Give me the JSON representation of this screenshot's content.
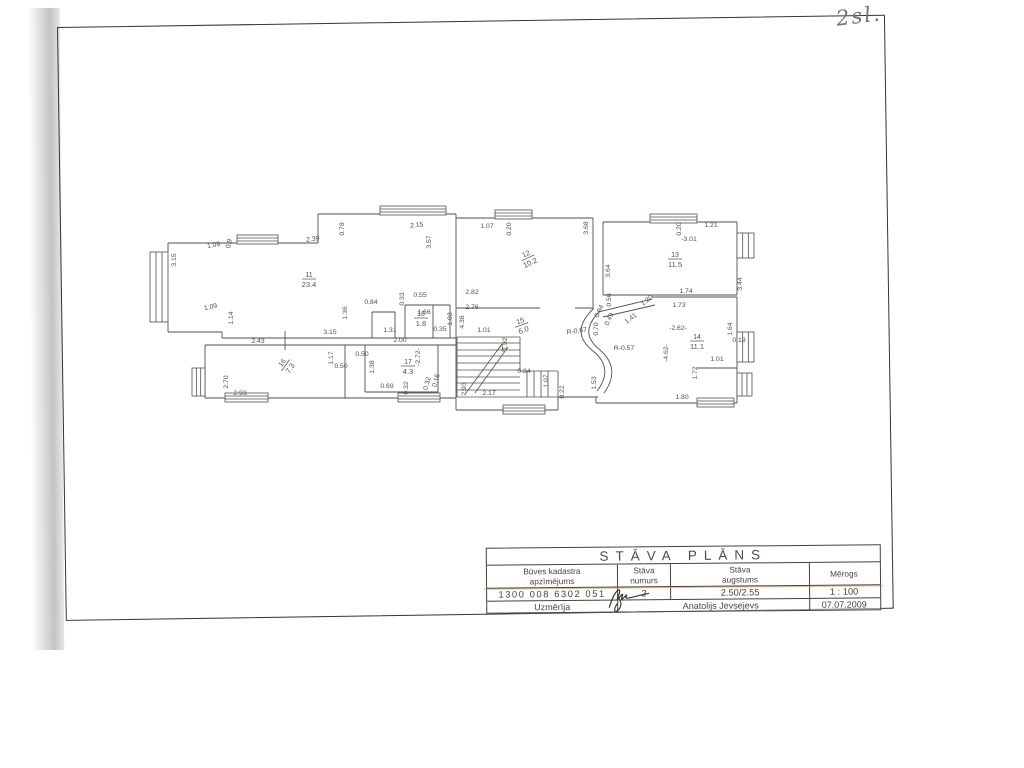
{
  "page": {
    "handwriting": "2sl.",
    "ink": "#544e46",
    "accent_highlight": "#d0802a"
  },
  "title_block": {
    "title": "STĀVA PLĀNS",
    "header_lines": [
      [
        "Būves kadastra",
        "apzīmējums"
      ],
      [
        "Stāva",
        "numurs"
      ],
      [
        "Stāva",
        "augstums"
      ],
      [
        "Mērogs",
        ""
      ]
    ],
    "values": [
      "1300 008 6302 051",
      "2",
      "2.50/2.55",
      "1 : 100"
    ],
    "surveyor_label": "Uzmērīja",
    "surveyor_name": "Anatolijs Jevsejevs",
    "date": "07.07.2009"
  },
  "plan": {
    "rooms": [
      {
        "num": "11",
        "area": "23.4",
        "x": 309,
        "y": 277,
        "r": 0
      },
      {
        "num": "12",
        "area": "10.2",
        "x": 527,
        "y": 256,
        "r": -25
      },
      {
        "num": "13",
        "area": "11.5",
        "x": 675,
        "y": 257,
        "r": 0
      },
      {
        "num": "14",
        "area": "11.1",
        "x": 697,
        "y": 339,
        "r": 0
      },
      {
        "num": "15",
        "area": "6.0",
        "x": 521,
        "y": 323,
        "r": -20
      },
      {
        "num": "16",
        "area": "7.3",
        "x": 284,
        "y": 364,
        "r": -55
      },
      {
        "num": "17",
        "area": "4.3",
        "x": 408,
        "y": 364,
        "r": 0
      },
      {
        "num": "18",
        "area": "1.8",
        "x": 421,
        "y": 316,
        "r": 0
      }
    ],
    "dims": [
      {
        "t": "1.09",
        "x": 214,
        "y": 247,
        "r": -10
      },
      {
        "t": "0.9",
        "x": 231,
        "y": 244,
        "r": -80
      },
      {
        "t": "2.39",
        "x": 313,
        "y": 241,
        "r": -6
      },
      {
        "t": "0.78",
        "x": 344,
        "y": 229,
        "r": -90
      },
      {
        "t": "2.15",
        "x": 417,
        "y": 227,
        "r": -6
      },
      {
        "t": "3.57",
        "x": 431,
        "y": 242,
        "r": -90
      },
      {
        "t": "1.07",
        "x": 487,
        "y": 228,
        "r": 0
      },
      {
        "t": "0.20",
        "x": 511,
        "y": 229,
        "r": -90
      },
      {
        "t": "3.68",
        "x": 588,
        "y": 228,
        "r": -90
      },
      {
        "t": "0.20",
        "x": 681,
        "y": 229,
        "r": -90
      },
      {
        "t": "1.21",
        "x": 711,
        "y": 227,
        "r": 0
      },
      {
        "t": "-3.01",
        "x": 689,
        "y": 241,
        "r": 0
      },
      {
        "t": "3.44",
        "x": 742,
        "y": 284,
        "r": -90
      },
      {
        "t": "3.15",
        "x": 176,
        "y": 260,
        "r": -90
      },
      {
        "t": "1.09",
        "x": 211,
        "y": 309,
        "r": -12
      },
      {
        "t": "1.14",
        "x": 233,
        "y": 318,
        "r": -90
      },
      {
        "t": "3.15",
        "x": 330,
        "y": 334,
        "r": 0
      },
      {
        "t": "0.84",
        "x": 371,
        "y": 304,
        "r": 0
      },
      {
        "t": "1.36",
        "x": 347,
        "y": 313,
        "r": -90
      },
      {
        "t": "0.33",
        "x": 404,
        "y": 299,
        "r": -90
      },
      {
        "t": "0.55",
        "x": 420,
        "y": 297,
        "r": 0
      },
      {
        "t": "1.66",
        "x": 424,
        "y": 314,
        "r": 0
      },
      {
        "t": "1.03",
        "x": 452,
        "y": 319,
        "r": -90
      },
      {
        "t": "1.31",
        "x": 390,
        "y": 332,
        "r": 0
      },
      {
        "t": "0.35",
        "x": 440,
        "y": 331,
        "r": 0
      },
      {
        "t": "2.43",
        "x": 258,
        "y": 343,
        "r": 0
      },
      {
        "t": "2.00",
        "x": 400,
        "y": 342,
        "r": 0
      },
      {
        "t": "1.17",
        "x": 333,
        "y": 358,
        "r": -90
      },
      {
        "t": "0.50",
        "x": 362,
        "y": 356,
        "r": 0
      },
      {
        "t": "0.50",
        "x": 341,
        "y": 368,
        "r": 0
      },
      {
        "t": "1.38",
        "x": 374,
        "y": 367,
        "r": -90
      },
      {
        "t": "-2.72-",
        "x": 420,
        "y": 357,
        "r": -90
      },
      {
        "t": "2.70",
        "x": 228,
        "y": 382,
        "r": -90
      },
      {
        "t": "2.93",
        "x": 240,
        "y": 395,
        "r": 0
      },
      {
        "t": "0.69",
        "x": 387,
        "y": 388,
        "r": 0
      },
      {
        "t": "0.32",
        "x": 408,
        "y": 388,
        "r": -90
      },
      {
        "t": "0.32",
        "x": 429,
        "y": 384,
        "r": -75
      },
      {
        "t": "0.16",
        "x": 438,
        "y": 381,
        "r": -75
      },
      {
        "t": "2.82",
        "x": 472,
        "y": 294,
        "r": 0
      },
      {
        "t": "2.76",
        "x": 472,
        "y": 309,
        "r": 0
      },
      {
        "t": "4.38",
        "x": 464,
        "y": 322,
        "r": -90
      },
      {
        "t": "1.01",
        "x": 484,
        "y": 332,
        "r": 0
      },
      {
        "t": "1.92",
        "x": 507,
        "y": 344,
        "r": -90
      },
      {
        "t": "0.84",
        "x": 524,
        "y": 373,
        "r": 0
      },
      {
        "t": "2.17",
        "x": 489,
        "y": 395,
        "r": 0
      },
      {
        "t": "2.93",
        "x": 466,
        "y": 389,
        "r": -90
      },
      {
        "t": "0.22",
        "x": 564,
        "y": 392,
        "r": -90
      },
      {
        "t": "1.07",
        "x": 548,
        "y": 381,
        "r": -90
      },
      {
        "t": "1.53",
        "x": 596,
        "y": 383,
        "r": -90
      },
      {
        "t": "R-0.67",
        "x": 577,
        "y": 333,
        "r": -8
      },
      {
        "t": "R-0.57",
        "x": 624,
        "y": 350,
        "r": 0
      },
      {
        "t": "0.56",
        "x": 611,
        "y": 300,
        "r": -90
      },
      {
        "t": "0.94",
        "x": 601,
        "y": 312,
        "r": -65
      },
      {
        "t": "0.49",
        "x": 611,
        "y": 320,
        "r": -65
      },
      {
        "t": "0.70",
        "x": 598,
        "y": 329,
        "r": -90
      },
      {
        "t": "1.41",
        "x": 632,
        "y": 320,
        "r": -38
      },
      {
        "t": "1.20",
        "x": 648,
        "y": 302,
        "r": -38
      },
      {
        "t": "3.64",
        "x": 610,
        "y": 271,
        "r": -90
      },
      {
        "t": "1.74",
        "x": 686,
        "y": 293,
        "r": 0
      },
      {
        "t": "1.73",
        "x": 679,
        "y": 307,
        "r": 0
      },
      {
        "t": "-2.62-",
        "x": 678,
        "y": 330,
        "r": 0
      },
      {
        "t": "-4.62-",
        "x": 668,
        "y": 353,
        "r": -90
      },
      {
        "t": "1.64",
        "x": 732,
        "y": 329,
        "r": -90
      },
      {
        "t": "0.19",
        "x": 739,
        "y": 342,
        "r": 0
      },
      {
        "t": "1.01",
        "x": 717,
        "y": 361,
        "r": 0
      },
      {
        "t": "1.72",
        "x": 697,
        "y": 373,
        "r": -90
      },
      {
        "t": "1.80",
        "x": 682,
        "y": 399,
        "r": 0
      }
    ],
    "walls": [
      [
        168,
        243,
        318,
        243
      ],
      [
        318,
        214,
        318,
        243
      ],
      [
        318,
        214,
        456,
        214
      ],
      [
        168,
        243,
        168,
        252
      ],
      [
        168,
        322,
        168,
        332
      ],
      [
        168,
        332,
        222,
        332
      ],
      [
        222,
        332,
        222,
        338
      ],
      [
        222,
        338,
        456,
        338
      ],
      [
        456,
        214,
        456,
        410
      ],
      [
        456,
        218,
        593,
        218
      ],
      [
        593,
        218,
        593,
        310
      ],
      [
        456,
        308,
        540,
        308
      ],
      [
        575,
        308,
        593,
        308
      ],
      [
        603,
        222,
        603,
        295
      ],
      [
        603,
        222,
        737,
        222
      ],
      [
        737,
        222,
        737,
        295
      ],
      [
        603,
        295,
        737,
        295
      ],
      [
        598,
        312,
        652,
        299
      ],
      [
        603,
        317,
        655,
        305
      ],
      [
        652,
        297,
        737,
        297
      ],
      [
        737,
        297,
        737,
        403
      ],
      [
        596,
        403,
        737,
        403
      ],
      [
        697,
        368,
        737,
        368
      ],
      [
        596,
        397,
        596,
        403
      ],
      [
        558,
        397,
        598,
        397
      ],
      [
        205,
        345,
        456,
        345
      ],
      [
        205,
        345,
        205,
        398
      ],
      [
        205,
        398,
        456,
        398
      ],
      [
        345,
        345,
        345,
        398
      ],
      [
        365,
        345,
        365,
        392
      ],
      [
        438,
        345,
        438,
        392
      ],
      [
        365,
        392,
        438,
        392
      ],
      [
        438,
        392,
        438,
        398
      ],
      [
        372,
        312,
        395,
        312
      ],
      [
        372,
        312,
        372,
        338
      ],
      [
        395,
        312,
        395,
        338
      ],
      [
        405,
        305,
        450,
        305
      ],
      [
        405,
        305,
        405,
        338
      ],
      [
        450,
        305,
        450,
        338
      ],
      [
        433,
        305,
        433,
        338
      ],
      [
        456,
        410,
        558,
        410
      ],
      [
        558,
        397,
        558,
        410
      ],
      [
        285,
        331,
        285,
        350
      ]
    ],
    "windows": [
      {
        "x": 237,
        "y": 235,
        "w": 41,
        "h": 9,
        "o": "h"
      },
      {
        "x": 380,
        "y": 206,
        "w": 66,
        "h": 9,
        "o": "h"
      },
      {
        "x": 495,
        "y": 210,
        "w": 37,
        "h": 9,
        "o": "h"
      },
      {
        "x": 650,
        "y": 214,
        "w": 47,
        "h": 9,
        "o": "h"
      },
      {
        "x": 737,
        "y": 233,
        "w": 17,
        "h": 25,
        "o": "v"
      },
      {
        "x": 737,
        "y": 332,
        "w": 17,
        "h": 30,
        "o": "v"
      },
      {
        "x": 737,
        "y": 373,
        "w": 15,
        "h": 23,
        "o": "v"
      },
      {
        "x": 697,
        "y": 398,
        "w": 37,
        "h": 9,
        "o": "h"
      },
      {
        "x": 150,
        "y": 252,
        "w": 18,
        "h": 70,
        "o": "v"
      },
      {
        "x": 192,
        "y": 368,
        "w": 13,
        "h": 28,
        "o": "v"
      },
      {
        "x": 225,
        "y": 393,
        "w": 43,
        "h": 9,
        "o": "h"
      },
      {
        "x": 398,
        "y": 393,
        "w": 42,
        "h": 9,
        "o": "h"
      },
      {
        "x": 503,
        "y": 405,
        "w": 42,
        "h": 9,
        "o": "h"
      }
    ],
    "stairs": [
      [
        457,
        337,
        520,
        337
      ],
      [
        457,
        337,
        457,
        397
      ],
      [
        520,
        337,
        520,
        371
      ],
      [
        520,
        371,
        558,
        371
      ],
      [
        558,
        371,
        558,
        397
      ],
      [
        457,
        397,
        558,
        397
      ],
      [
        457,
        343,
        520,
        343
      ],
      [
        457,
        350,
        520,
        350
      ],
      [
        457,
        356,
        520,
        356
      ],
      [
        457,
        363,
        520,
        363
      ],
      [
        457,
        370,
        520,
        370
      ],
      [
        457,
        377,
        520,
        377
      ],
      [
        457,
        383,
        520,
        383
      ],
      [
        457,
        390,
        520,
        390
      ],
      [
        527,
        371,
        527,
        397
      ],
      [
        534,
        371,
        534,
        397
      ],
      [
        541,
        371,
        541,
        397
      ],
      [
        548,
        371,
        548,
        397
      ],
      [
        466,
        393,
        502,
        344
      ],
      [
        475,
        393,
        508,
        347
      ],
      [
        502,
        344,
        497,
        351
      ],
      [
        502,
        344,
        503,
        352
      ]
    ],
    "curves": [
      "M 593 309 C 577 325 577 338 593 351 C 608 363 608 377 597 391",
      "M 600 311 C 585 326 585 338 600 350 C 615 363 615 378 604 393"
    ]
  }
}
